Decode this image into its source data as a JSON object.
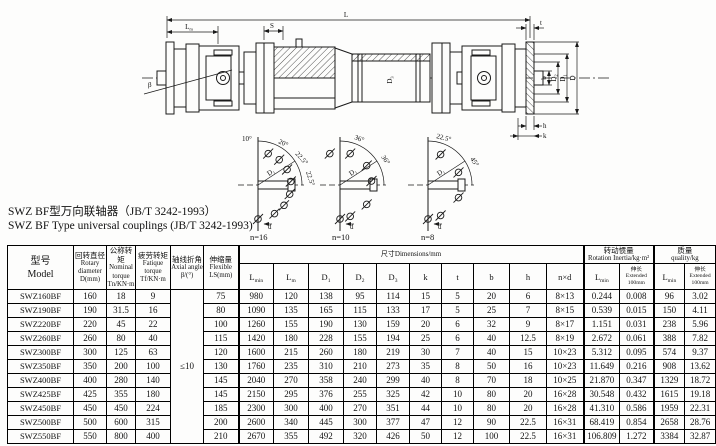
{
  "titles": {
    "zh": "SWZ BF型万向联轴器（JB/T 3242-1993）",
    "en": "SWZ BF Type universal couplings (JB/T 3242-1993)"
  },
  "drawing": {
    "labels": {
      "L": "L",
      "S": "S",
      "t": "t",
      "b": "b",
      "D": "D",
      "h": "h",
      "k": "k",
      "beta": "β",
      "d": "d"
    },
    "sym": {
      "Lm": [
        "L",
        "m"
      ],
      "Lmin": [
        "L",
        "min"
      ],
      "D1": [
        "D",
        "1"
      ],
      "D2": [
        "D",
        "2"
      ],
      "D3": [
        "D",
        "3"
      ]
    },
    "details": [
      {
        "caption": "n=16",
        "angles": [
          "10°",
          "20°",
          "22.5°",
          "22.5°"
        ]
      },
      {
        "caption": "n=10",
        "angles": [
          "36°",
          "36°"
        ]
      },
      {
        "caption": "n=8",
        "angles": [
          "22.5°",
          "45°"
        ]
      }
    ]
  },
  "table": {
    "model_header": {
      "zh": "型号",
      "en": "Model"
    },
    "col_headers": [
      {
        "zh": "回转直径",
        "en": "Rotary",
        "en2": "diameter",
        "sym": "D(mm)"
      },
      {
        "zh": "公称转矩",
        "en": "Nominal",
        "en2": "torque",
        "sym": "Tn/KN·m"
      },
      {
        "zh": "疲劳转矩",
        "en": "Fatique",
        "en2": "torque",
        "sym": "Tf/KN·m"
      },
      {
        "zh": "轴线折角",
        "en": "Axial angle",
        "en2": "",
        "sym": "β/(°)"
      },
      {
        "zh": "伸缩量",
        "en": "Flexible",
        "en2": "",
        "sym": "LS(mm)"
      }
    ],
    "groups": {
      "dims": "尺寸Dimensions/mm",
      "inertia_zh": "转动惯量",
      "inertia_en": "Rotation Inertia/kg·m²",
      "mass_zh": "质量",
      "mass_en": "quality/kg"
    },
    "ext": {
      "zh": "伸长",
      "en": "Extended",
      "mm": "100mm"
    },
    "dim_cols": [
      [
        "L",
        "min"
      ],
      [
        "L",
        "m"
      ],
      [
        "D",
        "1"
      ],
      [
        "D",
        "2"
      ],
      [
        "D",
        "3"
      ],
      [
        "k",
        ""
      ],
      [
        "t",
        ""
      ],
      [
        "b",
        ""
      ],
      [
        "h",
        ""
      ],
      [
        "n×d",
        ""
      ]
    ],
    "axial_value": "≤10",
    "rows": [
      [
        "SWZ160BF",
        "160",
        "18",
        "9",
        "75",
        "980",
        "120",
        "138",
        "95",
        "114",
        "15",
        "5",
        "20",
        "6",
        "8×13",
        "0.244",
        "0.008",
        "96",
        "3.02"
      ],
      [
        "SWZ190BF",
        "190",
        "31.5",
        "16",
        "80",
        "1090",
        "135",
        "165",
        "115",
        "133",
        "17",
        "5",
        "25",
        "7",
        "8×15",
        "0.539",
        "0.015",
        "150",
        "4.11"
      ],
      [
        "SWZ220BF",
        "220",
        "45",
        "22",
        "100",
        "1260",
        "155",
        "190",
        "130",
        "159",
        "20",
        "6",
        "32",
        "9",
        "8×17",
        "1.151",
        "0.031",
        "238",
        "5.96"
      ],
      [
        "SWZ260BF",
        "260",
        "80",
        "40",
        "115",
        "1420",
        "180",
        "228",
        "155",
        "194",
        "25",
        "6",
        "40",
        "12.5",
        "8×19",
        "2.672",
        "0.061",
        "388",
        "7.82"
      ],
      [
        "SWZ300BF",
        "300",
        "125",
        "63",
        "120",
        "1600",
        "215",
        "260",
        "180",
        "219",
        "30",
        "7",
        "40",
        "15",
        "10×23",
        "5.312",
        "0.095",
        "574",
        "9.37"
      ],
      [
        "SWZ350BF",
        "350",
        "200",
        "100",
        "130",
        "1760",
        "235",
        "310",
        "210",
        "273",
        "35",
        "8",
        "50",
        "16",
        "10×23",
        "11.649",
        "0.216",
        "908",
        "13.62"
      ],
      [
        "SWZ400BF",
        "400",
        "280",
        "140",
        "145",
        "2040",
        "270",
        "358",
        "240",
        "299",
        "40",
        "8",
        "70",
        "18",
        "10×25",
        "21.870",
        "0.347",
        "1329",
        "18.72"
      ],
      [
        "SWZ425BF",
        "425",
        "355",
        "180",
        "145",
        "2150",
        "295",
        "376",
        "255",
        "325",
        "42",
        "10",
        "80",
        "20",
        "16×28",
        "30.548",
        "0.432",
        "1615",
        "19.18"
      ],
      [
        "SWZ450BF",
        "450",
        "450",
        "224",
        "185",
        "2300",
        "300",
        "400",
        "270",
        "351",
        "44",
        "10",
        "80",
        "20",
        "16×28",
        "41.310",
        "0.586",
        "1959",
        "22.31"
      ],
      [
        "SWZ500BF",
        "500",
        "600",
        "315",
        "200",
        "2600",
        "340",
        "445",
        "300",
        "377",
        "47",
        "12",
        "90",
        "22.5",
        "16×31",
        "68.419",
        "0.854",
        "2658",
        "28.76"
      ],
      [
        "SWZ550BF",
        "550",
        "800",
        "400",
        "210",
        "2670",
        "355",
        "492",
        "320",
        "426",
        "50",
        "12",
        "100",
        "22.5",
        "16×31",
        "106.809",
        "1.272",
        "3384",
        "32.87"
      ]
    ]
  }
}
